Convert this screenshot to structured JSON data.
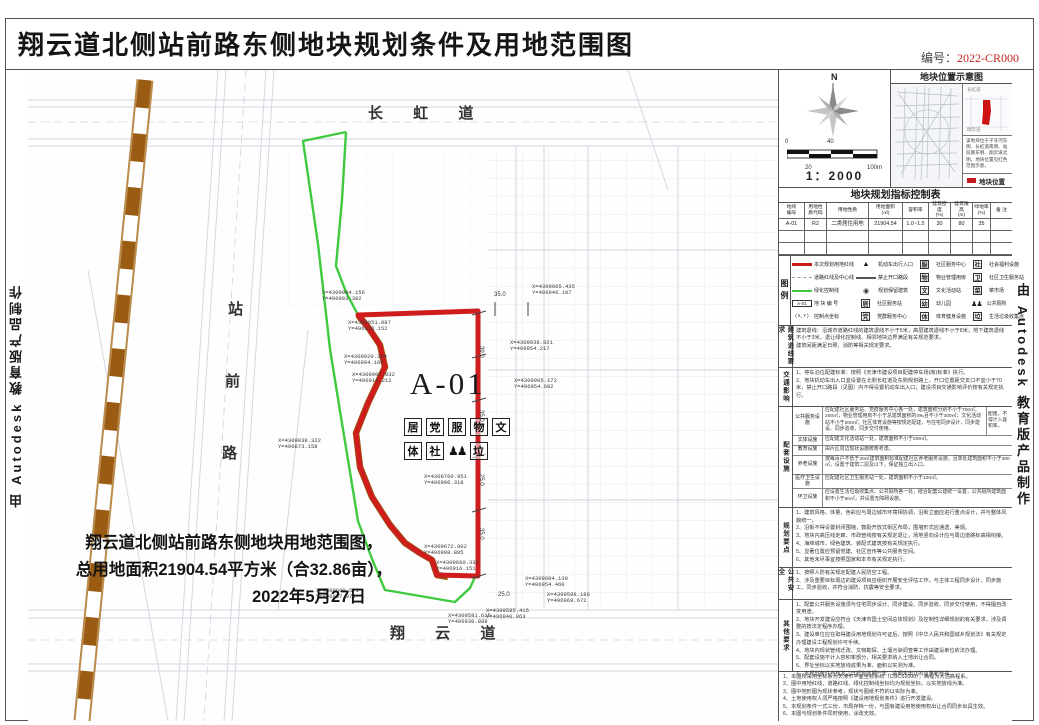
{
  "colors": {
    "accent_red": "#c2271d",
    "boundary_red": "#cf1d1d",
    "green_line": "#3fca3f",
    "railway_brown": "#9a5c12"
  },
  "title": "翔云道北侧站前路东侧地块规划条件及用地范围图",
  "doc_no_label": "编号：",
  "doc_no": "2022-CR000",
  "side_credit": "由 Autodesk 教育版产品制作",
  "map": {
    "roads": {
      "top": "长 虹 道",
      "bottom": "翔 云 道",
      "left_chars": [
        {
          "ch": "站",
          "x": 200,
          "y": 228
        },
        {
          "ch": "前",
          "x": 197,
          "y": 300
        },
        {
          "ch": "路",
          "x": 194,
          "y": 372
        }
      ]
    },
    "parcel_id": "A-01",
    "icons_row1": [
      "居",
      "党",
      "服",
      "物",
      "文"
    ],
    "icons_row2a": [
      "体",
      "社"
    ],
    "wc_figs": "♟♟",
    "icons_row2b": [
      "垃"
    ],
    "note_lines": {
      "l1": "翔云道北侧站前路东侧地块用地范围图，",
      "l2": "总用地面积21904.54平方米（合32.86亩），",
      "l3": "2022年5月27日"
    },
    "coords": [
      {
        "x": 294,
        "y": 220,
        "a": "X=4309964.156",
        "b": "Y=496903.302"
      },
      {
        "x": 320,
        "y": 250,
        "a": "X=4309951.087",
        "b": "Y=496916.152"
      },
      {
        "x": 316,
        "y": 284,
        "a": "X=4309920.304",
        "b": "Y=496904.106"
      },
      {
        "x": 324,
        "y": 302,
        "a": "X=4309907.832",
        "b": "Y=496916.212"
      },
      {
        "x": 250,
        "y": 368,
        "a": "X=4309838.322",
        "b": "Y=496873.158"
      },
      {
        "x": 504,
        "y": 214,
        "a": "X=4309965.435",
        "b": "Y=496946.107"
      },
      {
        "x": 482,
        "y": 270,
        "a": "X=4309938.921",
        "b": "Y=496954.217"
      },
      {
        "x": 486,
        "y": 308,
        "a": "X=4309905.172",
        "b": "Y=496954.682"
      },
      {
        "x": 396,
        "y": 404,
        "a": "X=4309760.951",
        "b": "Y=496906.318"
      },
      {
        "x": 396,
        "y": 474,
        "a": "X=4309672.902",
        "b": "Y=496908.885"
      },
      {
        "x": 408,
        "y": 490,
        "a": "X=4309660.332",
        "b": "Y=496916.151"
      },
      {
        "x": 288,
        "y": 518,
        "a": "X=4309600.571",
        "b": "Y=496887.071"
      },
      {
        "x": 420,
        "y": 543,
        "a": "X=4309581.615",
        "b": "Y=496930.888"
      },
      {
        "x": 497,
        "y": 506,
        "a": "X=4309604.130",
        "b": "Y=496954.460"
      },
      {
        "x": 519,
        "y": 522,
        "a": "X=4309598.186",
        "b": "Y=496969.672"
      },
      {
        "x": 458,
        "y": 538,
        "a": "X=4309585.415",
        "b": "Y=496940.863"
      }
    ],
    "dims_v": [
      {
        "x": 456,
        "y": 276,
        "t": "39.0"
      },
      {
        "x": 456,
        "y": 340,
        "t": "35.0"
      },
      {
        "x": 456,
        "y": 404,
        "t": "25.0"
      },
      {
        "x": 456,
        "y": 458,
        "t": "35.0"
      }
    ],
    "dims_h": [
      {
        "x": 466,
        "y": 222,
        "t": "35.0"
      },
      {
        "x": 470,
        "y": 522,
        "t": "25.0"
      }
    ]
  },
  "panel": {
    "compass": {
      "north": "N",
      "scale": "1：2000",
      "tick0": "0",
      "tick20": "20",
      "tick40": "40",
      "tick100": "100m"
    },
    "location": {
      "title": "地块位置示意图",
      "mini_top": "长虹道",
      "mini_bottom": "翔云道",
      "caption": "该地块位于子牙河东侧、长虹道南侧、站前路东侧、翔云道北侧，地块位置见红色范围示意。",
      "legend_label": "地块位置"
    },
    "table": {
      "title": "地块规划指标控制表",
      "headers": [
        "地块\n编号",
        "用地性\n质代码",
        "用地性质",
        "用地面积\n(㎡)",
        "容积率",
        "建筑密度\n(%)",
        "建筑限高\n(m)",
        "绿地率\n(%)",
        "备 注"
      ],
      "row1": [
        "A-01",
        "R2",
        "二类居住用地",
        "21904.54",
        "1.0~1.5",
        "30",
        "80",
        "35",
        ""
      ],
      "row2": [
        "",
        "",
        "",
        "",
        "",
        "",
        "",
        "",
        ""
      ],
      "row3": [
        "",
        "",
        "",
        "",
        "",
        "",
        "",
        "",
        ""
      ]
    },
    "legend": {
      "label": "图例",
      "col1": [
        {
          "cls": "sym sym-lred",
          "ch": "",
          "label": "本次规划用地红线"
        },
        {
          "cls": "sym sym-ldash",
          "ch": "",
          "label": "道路红线及中心线"
        },
        {
          "cls": "sym sym-lgreen",
          "ch": "",
          "label": "绿化控制线"
        },
        {
          "cls": "sym sym-a01",
          "ch": "A-01",
          "label": "地 块 编 号"
        },
        {
          "cls": "sym sym-par",
          "ch": "(X,Y)",
          "label": "控制点坐标"
        }
      ],
      "col2": [
        {
          "cls": "sym sym-tri",
          "ch": "▲",
          "label": "机动车出行入口"
        },
        {
          "cls": "sym sym-lsolid",
          "ch": "",
          "label": "禁止开口路段"
        },
        {
          "cls": "sym sym-circ",
          "ch": "◉",
          "label": "规划保留建筑"
        },
        {
          "cls": "sym-char",
          "ch": "居",
          "label": "社区服务站"
        },
        {
          "cls": "sym-char",
          "ch": "党",
          "label": "党群服务中心"
        }
      ],
      "col3": [
        {
          "cls": "sym-char",
          "ch": "服",
          "label": "社区服务中心"
        },
        {
          "cls": "sym-char",
          "ch": "物",
          "label": "物业管理用房"
        },
        {
          "cls": "sym-char",
          "ch": "文",
          "label": "文化活动站"
        },
        {
          "cls": "sym-char",
          "ch": "幼",
          "label": "幼儿园"
        },
        {
          "cls": "sym-char",
          "ch": "体",
          "label": "体育健身设施"
        }
      ],
      "col4": [
        {
          "cls": "sym-char",
          "ch": "社",
          "label": "社会福利设施"
        },
        {
          "cls": "sym-char",
          "ch": "卫",
          "label": "社区卫生服务站"
        },
        {
          "cls": "sym-char",
          "ch": "菜",
          "label": "菜市场"
        },
        {
          "cls": "sym-figs",
          "ch": "♟♟",
          "label": "公共厕所"
        },
        {
          "cls": "sym-char",
          "ch": "垃",
          "label": "生活垃圾收集点"
        }
      ]
    },
    "sections": {
      "setback": {
        "label": "建筑退线要求",
        "lines": [
          "建筑退线：沿城市道路红线的建筑退线不小于5米，高层建筑退线不小于8米；地下建筑退线不小于3米，退让绿化控制线、相邻地块边界满足有关规范要求。",
          "建筑间距满足日照、消防等相关规定要求。"
        ]
      },
      "traffic": {
        "label": "交通影响",
        "lines": [
          "1、停车泊位配建标准：按照《天津市建设项目配建停车场(库)标准》执行。",
          "2、地块机动车出入口宜设置在北侧长虹道及东侧规划路上，开口位置距交叉口不宜小于70米，禁止开口路段（见图）内不得设置机动车出入口；建设项目交通影响评价按有关规定执行。"
        ]
      },
      "facilities": {
        "label": "配套设施",
        "rows": [
          {
            "lab": "公共服务设施",
            "txt": "应配建社区服务站、党群服务中心各一处，建筑面积分别不小于700㎡、200㎡；物业管理用房不小于总建筑面积的4‰且不小于300㎡；文化活动站不小于200㎡；社区体育设施等按规定配建，与住宅同步设计、同步建设、同步验收、同步交付使用。",
            "note": "配建，不得计入容积率。"
          },
          {
            "lab": "文体设施",
            "txt": "应配建文化活动站一处，建筑面积不小于200㎡。",
            "note": ""
          },
          {
            "lab": "教育设施",
            "txt": "由片区周边现状设施统筹考虑。",
            "note": ""
          },
          {
            "lab": "养老设施",
            "txt": "按每百户不低于30㎡建筑面积标准配建社区养老服务设施，且单处建筑面积不小于300㎡，设置于建筑二层及以下，保证独立出入口。",
            "note": ""
          },
          {
            "lab": "医疗卫生设施",
            "txt": "应配建社区卫生服务站一处，建筑面积不小于120㎡。",
            "note": ""
          },
          {
            "lab": "环卫设施",
            "txt": "应设置生活垃圾收集点、公共厕所各一处，结合配套公建统一设置，公共厕所建筑面积不小于60㎡，并设置无障碍设施。",
            "note": ""
          }
        ]
      },
      "design": {
        "label": "规划要点",
        "lines": [
          "1、建筑风格、体量、色彩应与周边城市环境相协调，沿街立面应进行重点设计，并与整体风貌统一。",
          "2、沿街不得设置封闭围墙，鼓励开放式街区布局；围墙形式应通透、美观。",
          "3、地块内高压线走廊、市政管线按有关规定退让，场地竖向设计应与周边道路标高相衔接。",
          "4、海绵城市、绿色建筑、装配式建筑按有关规定执行。",
          "5、显著位置应预留党建、社区宣传等公共服务空间。",
          "6、其他未尽事宜按照国家和本市有关规定执行。"
        ]
      },
      "safety": {
        "label": "公共安全",
        "lines": [
          "1、按照人防有关规定配建人民防空工程。",
          "2、涉及重要目标周边的建设项目应组织开展安全评估工作，与主体工程同步设计、同步施工、同步验收，并符合消防、抗震等安全要求。"
        ]
      },
      "other": {
        "label": "其他要求",
        "lines": [
          "1、配套公共服务设施须与住宅同步设计、同步建设、同步验收、同步交付使用，不得擅自改变用途。",
          "2、地块开发建设应符合《天津市国土空间总体规划》及控制性详细规划的有关要求，涉及调整的按法定程序办理。",
          "3、建设单位应在取得建设用地规划许可证后，按照《中华人民共和国城乡规划法》有关规定办理建设工程规划许可手续。",
          "4、地块内现状管线迁改、文物勘探、土壤污染调查等工作由建设单位依法办理。",
          "5、配套设施不计入容积率部分，相关要求纳入土地出让合同。",
          "6、界址坐标以实地放线成果为准，面积以实测为准。",
          "7、本规划条件自核发之日起有效期一年，逾期未出让的应重新核提。"
        ]
      }
    },
    "footnotes": [
      "1、本图所采用坐标系为天津市平面坐标系统（CGCS2000），高程为大沽高程系。",
      "2、图中用地红线、道路红线、绿化控制线坐标均为规划坐标，以实地放线为准。",
      "3、图中地形图为现状参考，现状与图纸不符的以实际为准。",
      "4、土地使用权人须严格按照《建设用地规划条件》进行开发建设。",
      "5、本规划条件一式三份，市局存档一份，与国有建设用地使用权出让合同同步出具生效。",
      "6、本图与规划条件同时使用，涂改无效。"
    ]
  }
}
